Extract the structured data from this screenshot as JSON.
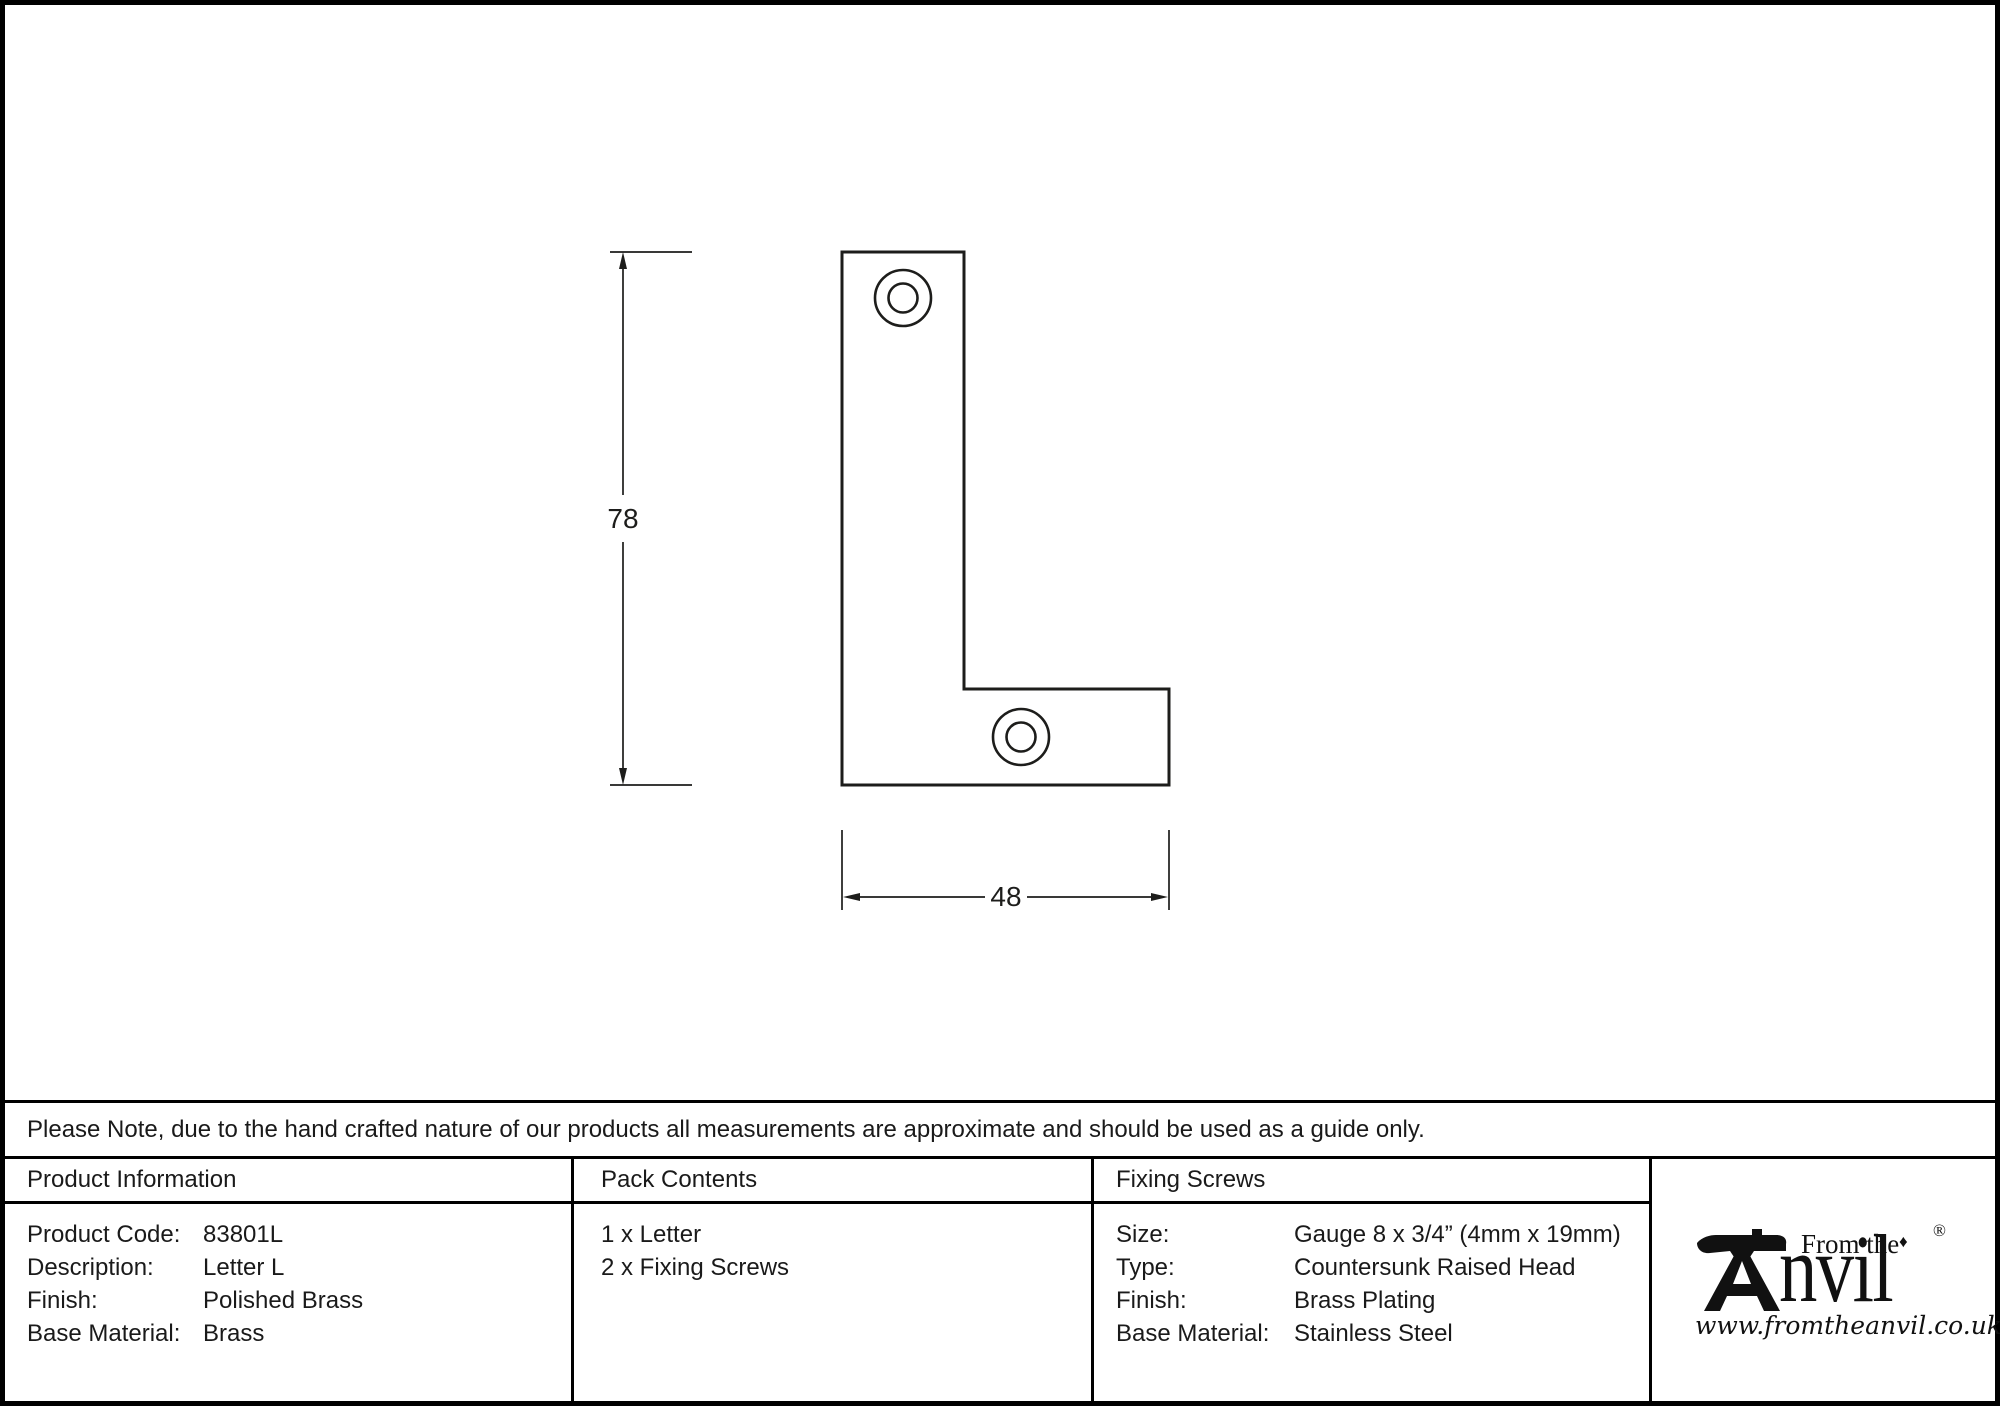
{
  "note": "Please Note, due to the hand crafted nature of our products all measurements are approximate and should be used as a guide only.",
  "drawing": {
    "height_label": "78",
    "width_label": "48"
  },
  "product_information": {
    "header": "Product Information",
    "rows": [
      {
        "label": "Product Code:",
        "value": "83801L"
      },
      {
        "label": "Description:",
        "value": "Letter L"
      },
      {
        "label": "Finish:",
        "value": "Polished Brass"
      },
      {
        "label": "Base Material:",
        "value": "Brass"
      }
    ]
  },
  "pack_contents": {
    "header": "Pack Contents",
    "items": [
      "1 x Letter",
      "2 x Fixing Screws"
    ]
  },
  "fixing_screws": {
    "header": "Fixing Screws",
    "rows": [
      {
        "label": "Size:",
        "value": "Gauge 8 x 3/4” (4mm x 19mm)"
      },
      {
        "label": "Type:",
        "value": "Countersunk Raised Head"
      },
      {
        "label": "Finish:",
        "value": "Brass Plating"
      },
      {
        "label": "Base Material:",
        "value": "Stainless Steel"
      }
    ]
  },
  "logo": {
    "from_the": "From the",
    "brand": "nvil",
    "diamond": "♦",
    "registered": "®",
    "website": "www.fromtheanvil.co.uk"
  },
  "colors": {
    "line": "#1d1d1b",
    "border": "#000000",
    "background": "#ffffff"
  }
}
